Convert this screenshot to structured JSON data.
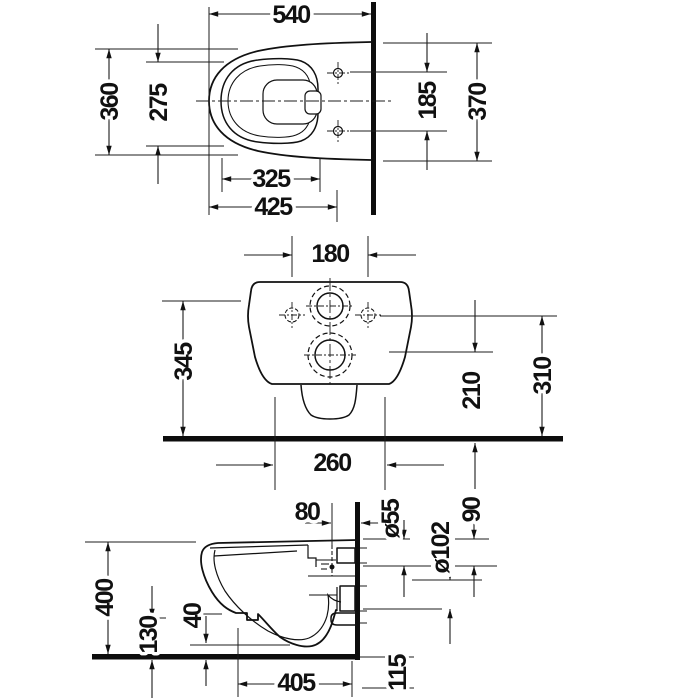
{
  "drawing": {
    "kind": "wall-hung toilet installation drawing, three orthographic views",
    "colors": {
      "line": "#1c1c1c",
      "background": "#ffffff"
    }
  },
  "views": {
    "plan": {
      "dims": {
        "depth_total": "540",
        "width_outer": "360",
        "width_inner": "275",
        "seat_hole_spacing": "185",
        "width_at_wall": "370",
        "depth_inner": "325",
        "depth_seat": "425"
      }
    },
    "rear": {
      "dims": {
        "fixing_hole_spacing": "180",
        "body_height": "345",
        "outlet_center_height": "210",
        "fixing_height": "310",
        "base_width": "260"
      }
    },
    "side": {
      "dims": {
        "inlet_offset": "80",
        "inlet_diameter": "ø55",
        "rim_to_inlet": "90",
        "outlet_diameter": "ø102",
        "front_height": "400",
        "underside_clearance": "130",
        "bottom_gap": "40",
        "depth_from_wall": "405",
        "below_floor": "115"
      }
    }
  }
}
